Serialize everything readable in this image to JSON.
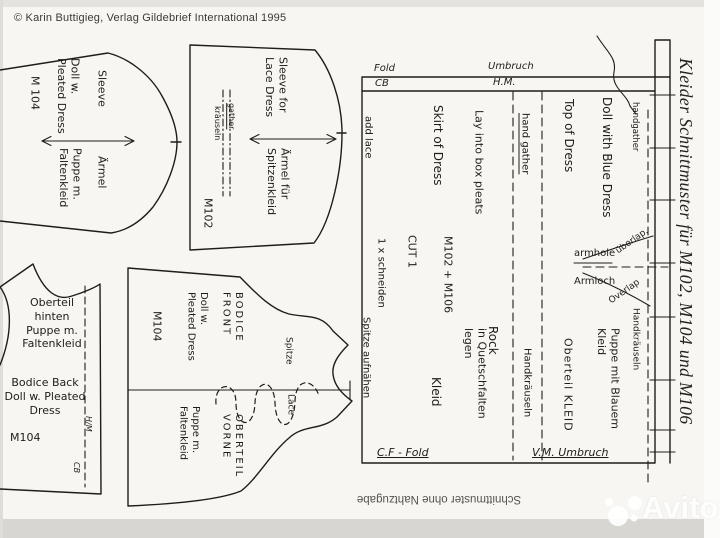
{
  "colors": {
    "paper": "#f7f6f2",
    "ink": "#1e1d1b",
    "note_gray": "#55544f",
    "watermark_white": "#ffffff"
  },
  "header": {
    "copyright": "© Karin Buttigieg, Verlag Gildebrief International 1995"
  },
  "side_title": "Kleider Schnittmuster für M102, M104 und M106",
  "footer": {
    "note": "Schnittmuster ohne Nahtzugabe",
    "watermark": "Avito"
  },
  "sleeve_m104": {
    "name_en": "Sleeve",
    "desc_en_1": "Doll w.",
    "desc_en_2": "Pleated Dress",
    "code": "M 104",
    "name_de": "Ärmel",
    "desc_de_1": "Puppe m.",
    "desc_de_2": "Faltenkleid"
  },
  "sleeve_m102": {
    "name_en_1": "Sleeve for",
    "name_en_2": "Lace Dress",
    "gather_en": "gather",
    "gather_de": "kräuseln",
    "name_de_1": "Ärmel für",
    "name_de_2": "Spitzenkleid",
    "code": "M102"
  },
  "dress": {
    "fold_en": "Fold",
    "cb": "CB",
    "fold_de": "Umbruch",
    "hm": "H.M.",
    "add_lace": "add lace",
    "skirt_en": "Skirt of Dress",
    "box_pleats_en": "Lay into box pleats",
    "hand_gather": "hand gather",
    "top_en": "Top of Dress",
    "doll_blue_en": "Doll with Blue Dress",
    "handgather": "handgather",
    "codes": "M102 + M106",
    "cut_en": "CUT 1",
    "cut_de": "1 x schneiden",
    "lace_de": "Spitze aufnähen",
    "skirt_de_1": "Rock",
    "skirt_de_2": "Kleid",
    "box_pleats_de_1": "in Quetschfalten",
    "box_pleats_de_2": "legen",
    "hand_gather_de": "Handkräuseln",
    "armhole_en": "armhole",
    "armhole_de": "Armloch",
    "overlap_de": "überlap.",
    "overlap_en": "Overlap",
    "hand_gather_de_2": "Handkräuseln",
    "doll_blue_de_1": "Puppe mit Blauem",
    "doll_blue_de_2": "Kleid",
    "top_de": "Oberteil KLEID",
    "cf_fold": "C.F - Fold",
    "vm_umbruch": "V.M. Umbruch"
  },
  "bodice_back": {
    "de_1": "Oberteil",
    "de_2": "hinten",
    "de_3": "Puppe m.",
    "de_4": "Faltenkleid",
    "en_1": "Bodice Back",
    "en_2": "Doll w. Pleated",
    "en_3": "Dress",
    "code": "M104",
    "hm": "H/M",
    "cb": "CB"
  },
  "bodice_front": {
    "en_1": "BODICE",
    "en_2": "FRONT",
    "desc_1": "Doll w.",
    "desc_2": "Pleated Dress",
    "code": "M104",
    "lace_de": "Spitze",
    "lace_en": "Lace",
    "de_1": "OBERTEIL",
    "de_2": "VORNE",
    "puppe_1": "Puppe m.",
    "puppe_2": "Faltenkleid"
  }
}
